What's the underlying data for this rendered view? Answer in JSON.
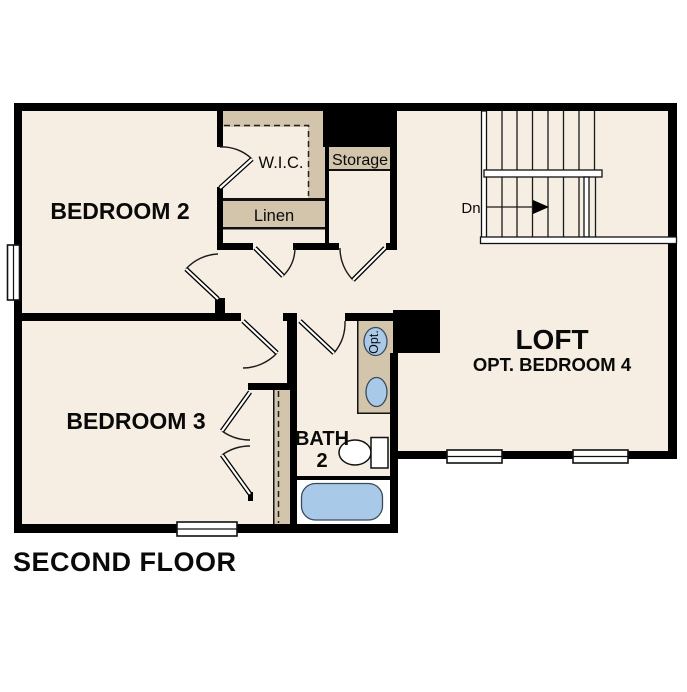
{
  "title": "SECOND FLOOR",
  "theme": {
    "background": "#ffffff",
    "floor": "#f6eee2",
    "closet": "#d2c5ac",
    "wall": "#000000",
    "fixture_blue": "#a9c9e9"
  },
  "rooms": {
    "bedroom2": "BEDROOM 2",
    "bedroom3": "BEDROOM 3",
    "loft": "LOFT",
    "loft_sub": "OPT. BEDROOM 4",
    "bath_line1": "BATH",
    "bath_line2": "2"
  },
  "closets": {
    "wic": "W.I.C.",
    "linen": "Linen",
    "storage": "Storage"
  },
  "stairs": {
    "direction": "Dn"
  },
  "fixtures": {
    "optional_sink": "Opt."
  }
}
